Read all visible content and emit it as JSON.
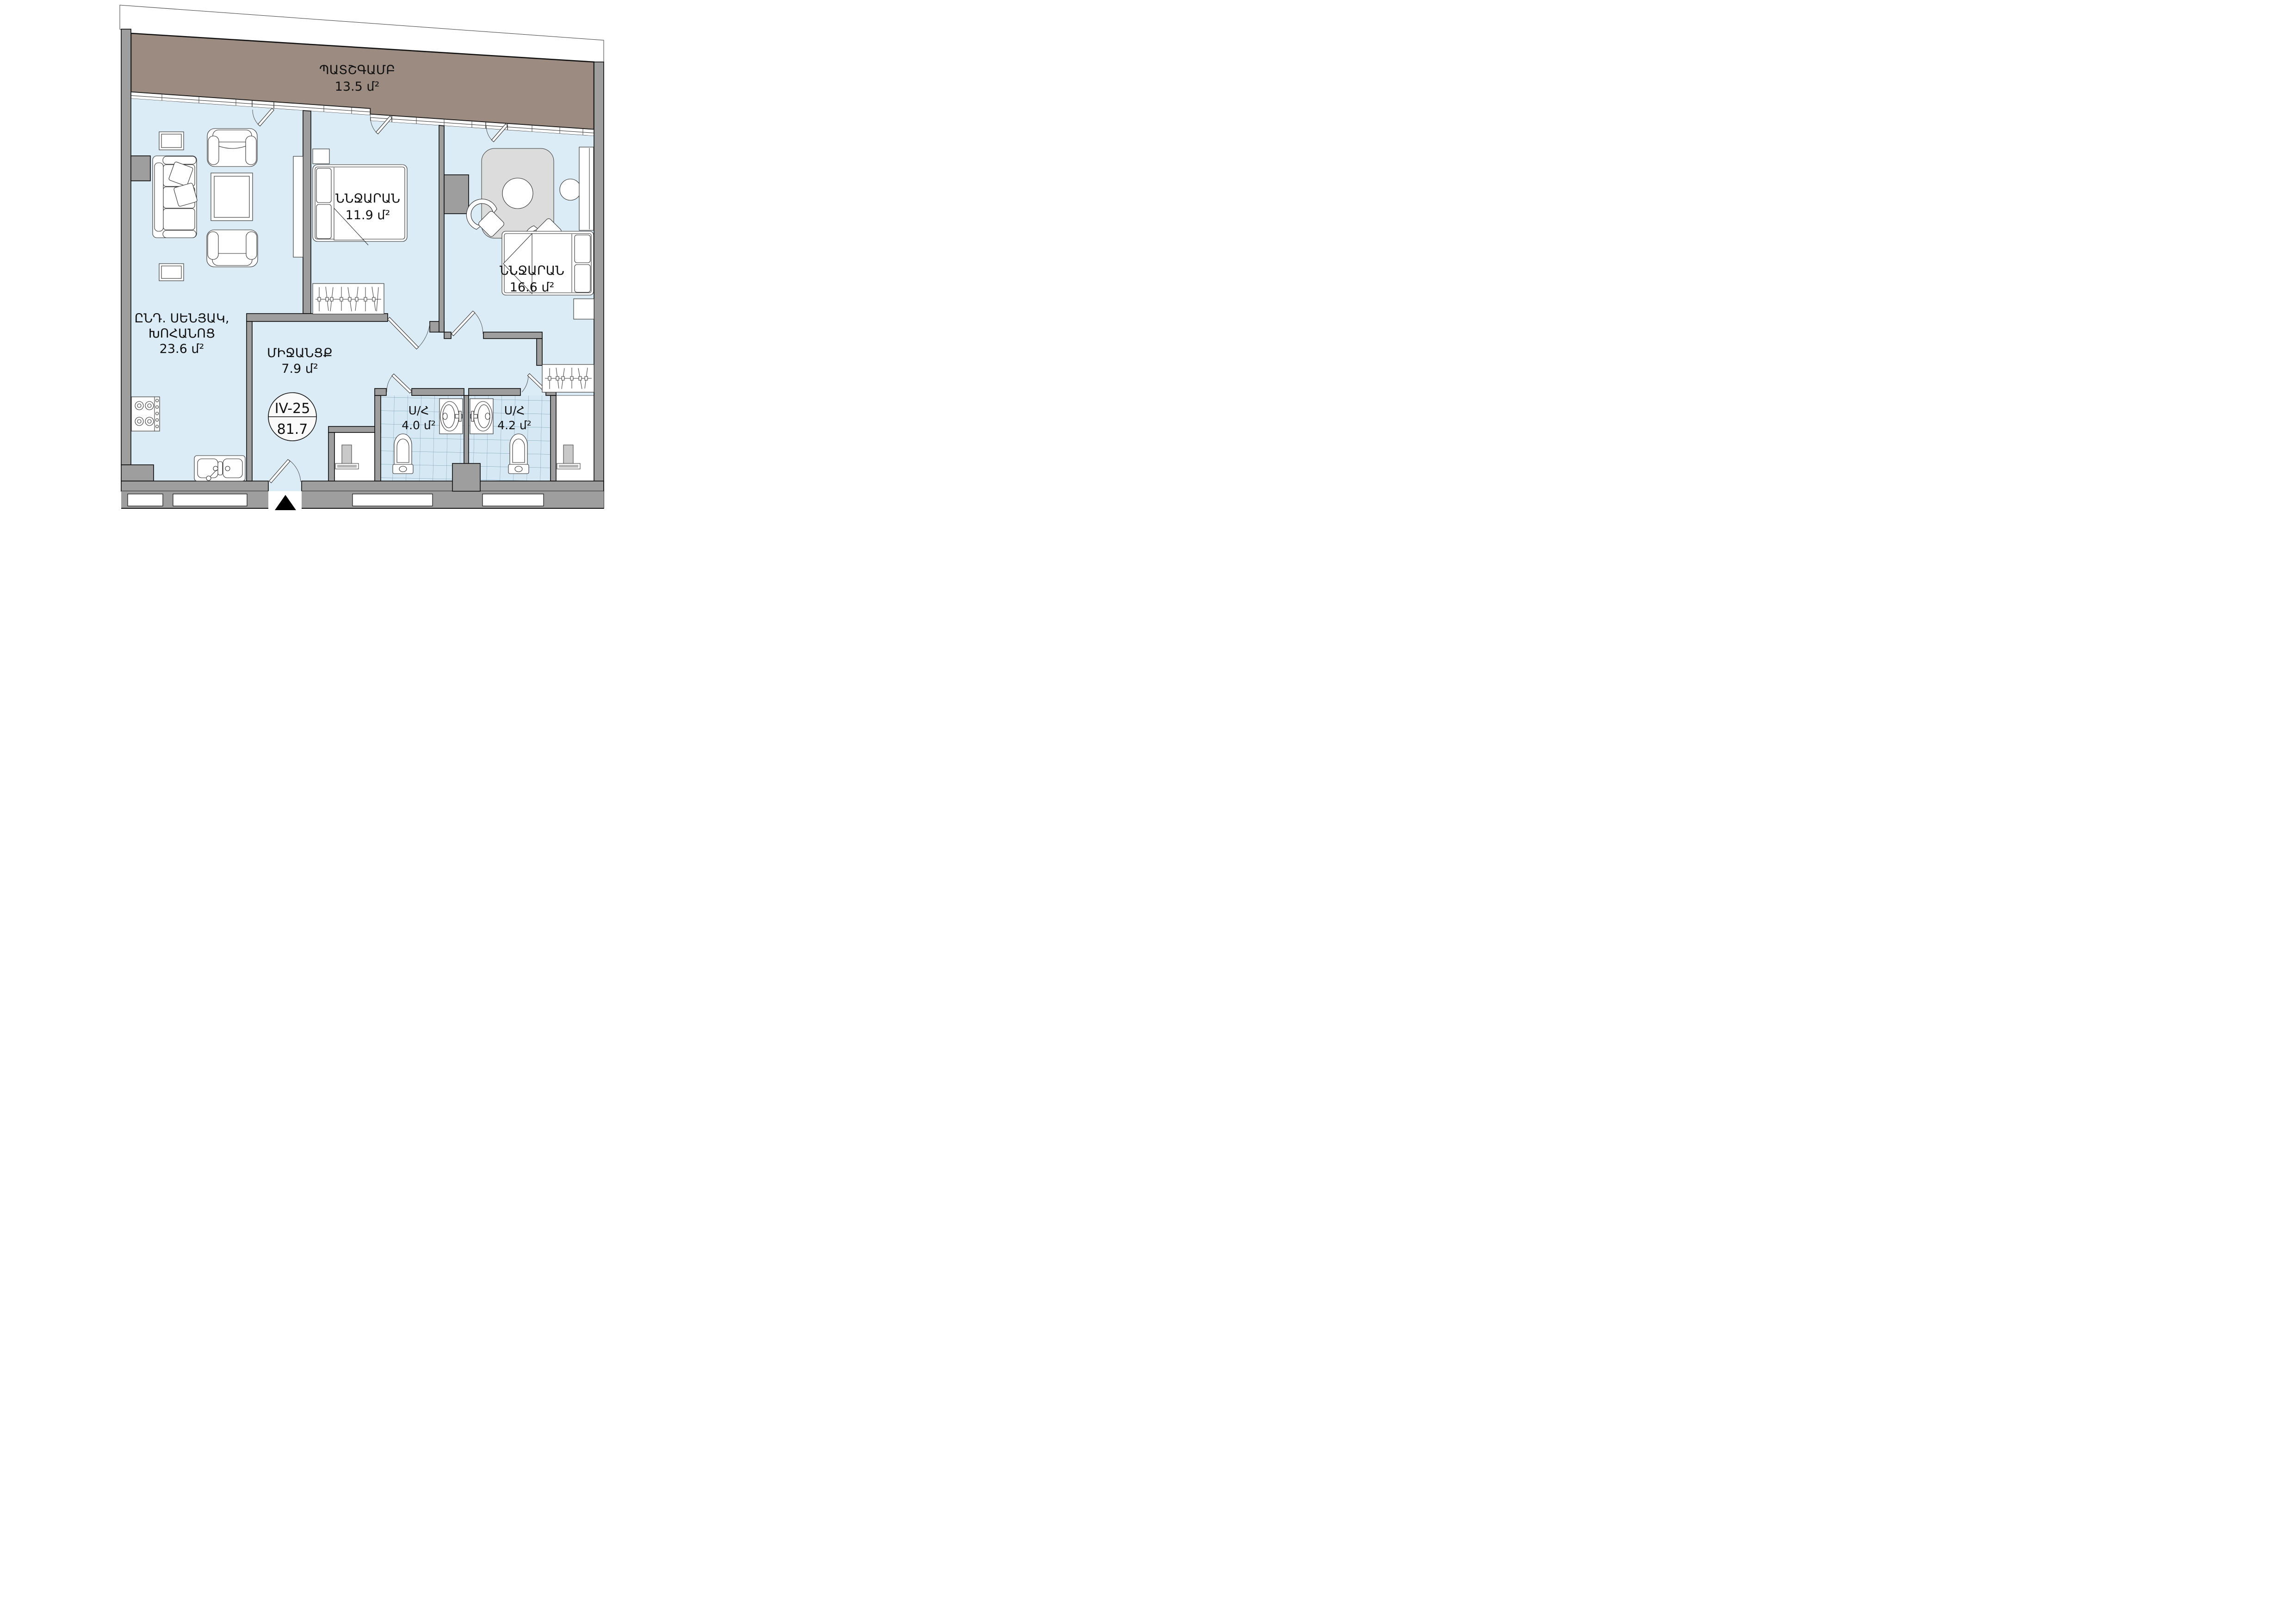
{
  "plan": {
    "type": "apartment-floor-plan",
    "unit_badge": {
      "unit_code": "IV-25",
      "total_area": "81.7"
    },
    "rooms": [
      {
        "key": "balcony",
        "label": "ՊԱՏՇԳԱՄԲ",
        "area": "13.5 մ²"
      },
      {
        "key": "bedroom-1",
        "label": "ՆՆՋԱՐԱՆ",
        "area": "11.9 մ²"
      },
      {
        "key": "bedroom-2",
        "label": "ՆՆՋԱՐԱՆ",
        "area": "16.6 մ²"
      },
      {
        "key": "living-kitchen",
        "label_line1": "ԸՆԴ. ՍԵՆՅԱԿ,",
        "label_line2": "ԽՈՀԱՆՈՑ",
        "area": "23.6 մ²"
      },
      {
        "key": "hallway",
        "label": "ՄԻՋԱՆՑՔ",
        "area": "7.9 մ²"
      },
      {
        "key": "bathroom-1",
        "label": "Ս/Հ",
        "area": "4.0 մ²"
      },
      {
        "key": "bathroom-2",
        "label": "Ս/Հ",
        "area": "4.2 մ²"
      }
    ],
    "colors": {
      "floor": "#dcecf6",
      "bath_floor": "#d6e8f3",
      "wall": "#9e9e9e",
      "balcony": "#9c8b80",
      "rug": "#dcdcdc",
      "outline": "#141414"
    }
  }
}
